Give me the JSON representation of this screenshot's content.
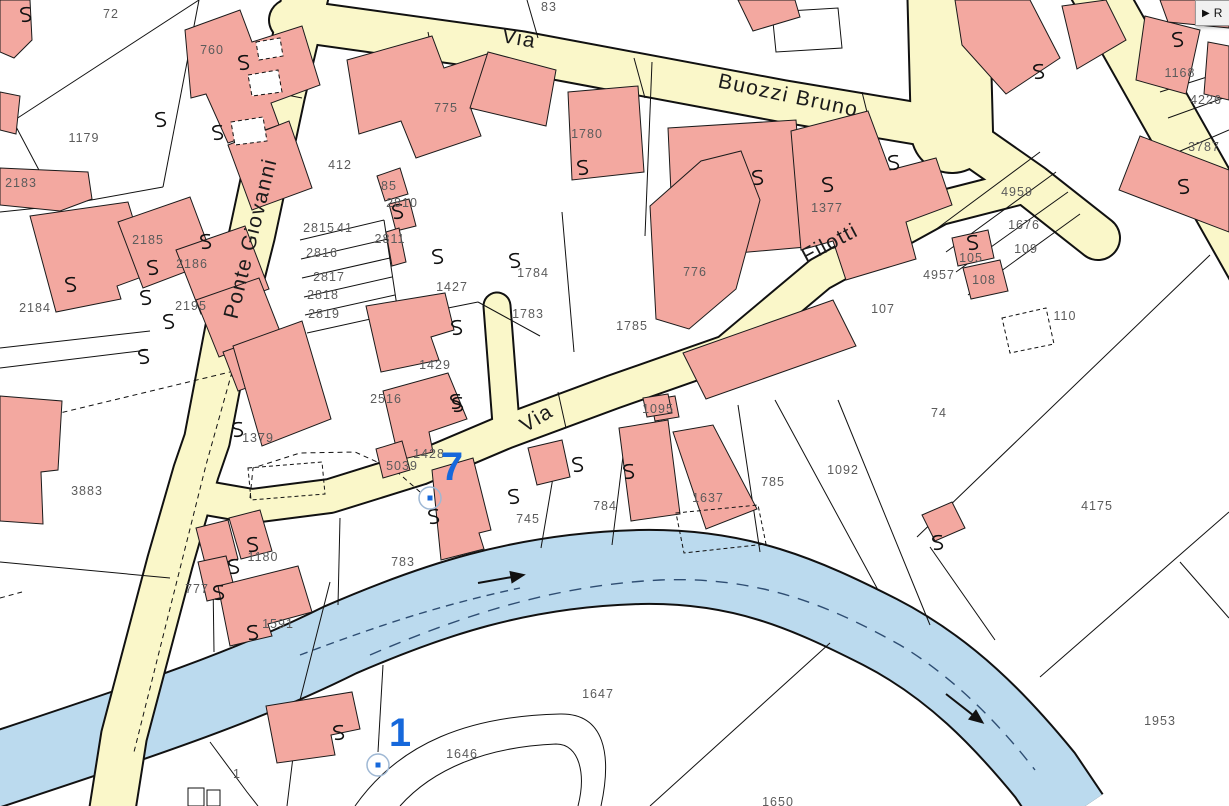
{
  "app": {
    "panel_toggle": {
      "icon": "▶",
      "label": "R"
    }
  },
  "map": {
    "colors": {
      "background": "#ffffff",
      "building_fill": "#F3A8A0",
      "building_stroke": "#1a1a1a",
      "road_fill": "#FAF7C9",
      "road_casing": "#111111",
      "water_fill": "#BBDAEE",
      "water_casing": "#111111",
      "water_dash": "#2e4d72",
      "parcel_line": "#111111",
      "label_color": "#5b5b5b",
      "street_label_color": "#1b1b1b",
      "marker_color": "#1668db",
      "marker_ring": "#9fb8d4"
    },
    "street_labels": [
      {
        "text": "Via",
        "x": 518,
        "y": 45,
        "rot": 10
      },
      {
        "text": "Buozzi Bruno",
        "x": 787,
        "y": 102,
        "rot": 12
      },
      {
        "text": "Ponte Giovanni",
        "x": 257,
        "y": 240,
        "rot": -76
      },
      {
        "text": "Filotti",
        "x": 833,
        "y": 249,
        "rot": -28
      },
      {
        "text": "Via",
        "x": 540,
        "y": 424,
        "rot": -31
      }
    ],
    "parcel_labels": [
      {
        "t": "72",
        "x": 111,
        "y": 18
      },
      {
        "t": "760",
        "x": 212,
        "y": 54
      },
      {
        "t": "83",
        "x": 549,
        "y": 11
      },
      {
        "t": "775",
        "x": 446,
        "y": 112
      },
      {
        "t": "1780",
        "x": 587,
        "y": 138
      },
      {
        "t": "412",
        "x": 340,
        "y": 169
      },
      {
        "t": "85",
        "x": 389,
        "y": 190
      },
      {
        "t": "2810",
        "x": 402,
        "y": 207
      },
      {
        "t": "1377",
        "x": 827,
        "y": 212
      },
      {
        "t": "1168",
        "x": 1180,
        "y": 77
      },
      {
        "t": "4226",
        "x": 1206,
        "y": 104
      },
      {
        "t": "3787",
        "x": 1204,
        "y": 151
      },
      {
        "t": "1179",
        "x": 84,
        "y": 142
      },
      {
        "t": "2183",
        "x": 21,
        "y": 187
      },
      {
        "t": "2185",
        "x": 148,
        "y": 244
      },
      {
        "t": "2186",
        "x": 192,
        "y": 268
      },
      {
        "t": "2195",
        "x": 191,
        "y": 310
      },
      {
        "t": "2184",
        "x": 35,
        "y": 312
      },
      {
        "t": "2815",
        "x": 319,
        "y": 232
      },
      {
        "t": "41",
        "x": 345,
        "y": 232
      },
      {
        "t": "2811",
        "x": 390,
        "y": 243
      },
      {
        "t": "2816",
        "x": 322,
        "y": 257
      },
      {
        "t": "2817",
        "x": 329,
        "y": 281
      },
      {
        "t": "2818",
        "x": 323,
        "y": 299
      },
      {
        "t": "2819",
        "x": 324,
        "y": 318
      },
      {
        "t": "1427",
        "x": 452,
        "y": 291
      },
      {
        "t": "1784",
        "x": 533,
        "y": 277
      },
      {
        "t": "1783",
        "x": 528,
        "y": 318
      },
      {
        "t": "1429",
        "x": 435,
        "y": 369
      },
      {
        "t": "2516",
        "x": 386,
        "y": 403
      },
      {
        "t": "776",
        "x": 695,
        "y": 276
      },
      {
        "t": "1785",
        "x": 632,
        "y": 330
      },
      {
        "t": "107",
        "x": 883,
        "y": 313
      },
      {
        "t": "4959",
        "x": 1017,
        "y": 196
      },
      {
        "t": "1676",
        "x": 1024,
        "y": 229
      },
      {
        "t": "109",
        "x": 1026,
        "y": 253
      },
      {
        "t": "105",
        "x": 971,
        "y": 262
      },
      {
        "t": "4957",
        "x": 939,
        "y": 279
      },
      {
        "t": "108",
        "x": 984,
        "y": 284
      },
      {
        "t": "110",
        "x": 1065,
        "y": 320
      },
      {
        "t": "1095",
        "x": 658,
        "y": 413
      },
      {
        "t": "1428",
        "x": 429,
        "y": 458
      },
      {
        "t": "5039",
        "x": 402,
        "y": 470
      },
      {
        "t": "1637",
        "x": 708,
        "y": 502
      },
      {
        "t": "745",
        "x": 528,
        "y": 523
      },
      {
        "t": "784",
        "x": 605,
        "y": 510
      },
      {
        "t": "785",
        "x": 773,
        "y": 486
      },
      {
        "t": "1092",
        "x": 843,
        "y": 474
      },
      {
        "t": "74",
        "x": 939,
        "y": 417
      },
      {
        "t": "4175",
        "x": 1097,
        "y": 510
      },
      {
        "t": "783",
        "x": 403,
        "y": 566
      },
      {
        "t": "1379",
        "x": 258,
        "y": 442
      },
      {
        "t": "3883",
        "x": 87,
        "y": 495
      },
      {
        "t": "1180",
        "x": 263,
        "y": 561
      },
      {
        "t": "777",
        "x": 197,
        "y": 593
      },
      {
        "t": "1591",
        "x": 278,
        "y": 628
      },
      {
        "t": "1",
        "x": 237,
        "y": 778
      },
      {
        "t": "1646",
        "x": 462,
        "y": 758
      },
      {
        "t": "1647",
        "x": 598,
        "y": 698
      },
      {
        "t": "1650",
        "x": 778,
        "y": 806
      },
      {
        "t": "1953",
        "x": 1160,
        "y": 725
      }
    ],
    "markers": [
      {
        "label": "7",
        "x": 452,
        "y": 480,
        "ring_x": 430,
        "ring_y": 498
      },
      {
        "label": "1",
        "x": 400,
        "y": 746,
        "ring_x": 378,
        "ring_y": 765
      }
    ],
    "flow_arrows": [
      {
        "x": 478,
        "y": 583,
        "rot": -10
      },
      {
        "x": 946,
        "y": 694,
        "rot": 38
      }
    ],
    "squiggles": [
      [
        25,
        15
      ],
      [
        160,
        120
      ],
      [
        243,
        63
      ],
      [
        217,
        133
      ],
      [
        397,
        212
      ],
      [
        437,
        257
      ],
      [
        514,
        261
      ],
      [
        456,
        328
      ],
      [
        455,
        402
      ],
      [
        582,
        168
      ],
      [
        757,
        178
      ],
      [
        827,
        185
      ],
      [
        893,
        163
      ],
      [
        972,
        243
      ],
      [
        1177,
        40
      ],
      [
        1038,
        72
      ],
      [
        1183,
        187
      ],
      [
        205,
        242
      ],
      [
        152,
        268
      ],
      [
        145,
        298
      ],
      [
        168,
        322
      ],
      [
        70,
        285
      ],
      [
        143,
        357
      ],
      [
        457,
        405
      ],
      [
        513,
        497
      ],
      [
        577,
        465
      ],
      [
        628,
        472
      ],
      [
        433,
        517
      ],
      [
        237,
        430
      ],
      [
        252,
        545
      ],
      [
        233,
        567
      ],
      [
        218,
        593
      ],
      [
        252,
        633
      ],
      [
        338,
        733
      ],
      [
        937,
        543
      ]
    ]
  }
}
